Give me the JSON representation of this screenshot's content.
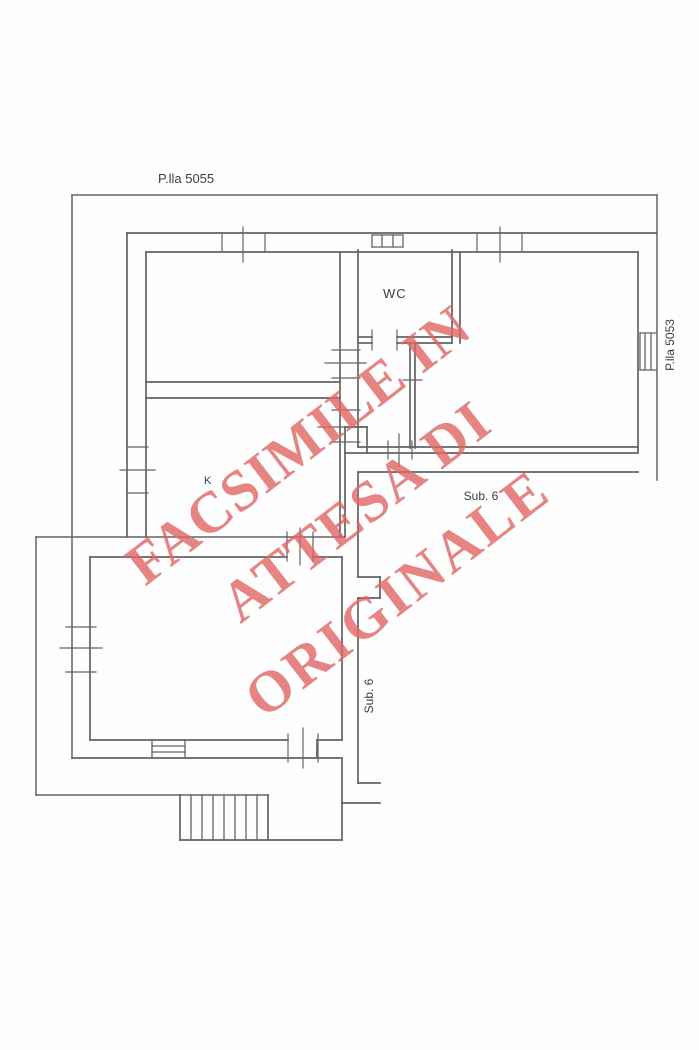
{
  "colors": {
    "line": "#636363",
    "label": "#3c3c3c",
    "watermark": "rgba(224,100,100,0.8)"
  },
  "labels": {
    "parcel_top": "P.lla 5055",
    "parcel_right": "P.lla 5053",
    "wc": "WC",
    "kitchen": "K",
    "sub6_horizontal": "Sub. 6",
    "sub6_vertical": "Sub. 6"
  },
  "watermark": {
    "rotation_deg": -37.5,
    "lines": [
      "FACSIMILE IN",
      "ATTESA DI",
      "ORIGINALE"
    ]
  },
  "floorplan": {
    "width": 699,
    "height": 1050,
    "segments": {
      "boundary": [
        [
          72,
          195,
          657,
          195
        ],
        [
          657,
          195,
          657,
          480
        ],
        [
          72,
          195,
          72,
          758
        ],
        [
          36,
          537,
          36,
          795
        ],
        [
          36,
          537,
          345,
          537
        ],
        [
          36,
          795,
          268,
          795
        ]
      ],
      "wall": [
        [
          127,
          233,
          656,
          233
        ],
        [
          146,
          252,
          638,
          252
        ],
        [
          127,
          233,
          127,
          537
        ],
        [
          146,
          252,
          146,
          537
        ],
        [
          638,
          252,
          638,
          452
        ],
        [
          146,
          382,
          340,
          382
        ],
        [
          146,
          398,
          340,
          398
        ],
        [
          340,
          252,
          340,
          537
        ],
        [
          358,
          250,
          358,
          447
        ],
        [
          452,
          250,
          452,
          343
        ],
        [
          460,
          252,
          460,
          343
        ],
        [
          358,
          337,
          372,
          337
        ],
        [
          397,
          337,
          452,
          337
        ],
        [
          358,
          343,
          372,
          343
        ],
        [
          397,
          343,
          452,
          343
        ],
        [
          410,
          343,
          410,
          448
        ],
        [
          415,
          343,
          415,
          448
        ],
        [
          358,
          447,
          638,
          447
        ],
        [
          345,
          453,
          638,
          453
        ],
        [
          345,
          427,
          367,
          427
        ],
        [
          345,
          427,
          345,
          453
        ],
        [
          367,
          427,
          367,
          453
        ],
        [
          345,
          453,
          345,
          537
        ],
        [
          358,
          472,
          638,
          472
        ],
        [
          358,
          472,
          358,
          577
        ],
        [
          358,
          577,
          380,
          577
        ],
        [
          380,
          577,
          380,
          598
        ],
        [
          380,
          598,
          358,
          598
        ],
        [
          358,
          598,
          358,
          783
        ],
        [
          358,
          783,
          380,
          783
        ],
        [
          342,
          803,
          380,
          803
        ],
        [
          90,
          557,
          287,
          557
        ],
        [
          313,
          557,
          342,
          557
        ],
        [
          90,
          557,
          90,
          740
        ],
        [
          342,
          557,
          342,
          740
        ],
        [
          90,
          740,
          288,
          740
        ],
        [
          317,
          740,
          342,
          740
        ],
        [
          317,
          740,
          317,
          758
        ],
        [
          72,
          758,
          342,
          758
        ],
        [
          342,
          758,
          342,
          840
        ],
        [
          180,
          795,
          180,
          840
        ],
        [
          268,
          795,
          268,
          840
        ],
        [
          180,
          840,
          342,
          840
        ]
      ],
      "window": [
        [
          372,
          235,
          403,
          235
        ],
        [
          372,
          247,
          403,
          247
        ],
        [
          372,
          235,
          372,
          247
        ],
        [
          403,
          235,
          403,
          247
        ],
        [
          382,
          235,
          382,
          247
        ],
        [
          393,
          235,
          393,
          247
        ],
        [
          640,
          333,
          656,
          333
        ],
        [
          640,
          370,
          656,
          370
        ],
        [
          640,
          333,
          640,
          370
        ],
        [
          645,
          333,
          645,
          370
        ],
        [
          651,
          333,
          651,
          370
        ],
        [
          152,
          740,
          152,
          758
        ],
        [
          185,
          740,
          185,
          758
        ],
        [
          152,
          746,
          185,
          746
        ],
        [
          152,
          752,
          185,
          752
        ]
      ],
      "tick": [
        [
          222,
          233,
          222,
          252
        ],
        [
          243,
          227,
          243,
          262
        ],
        [
          265,
          233,
          265,
          252
        ],
        [
          477,
          233,
          477,
          252
        ],
        [
          500,
          227,
          500,
          262
        ],
        [
          522,
          233,
          522,
          252
        ],
        [
          332,
          350,
          360,
          350
        ],
        [
          325,
          363,
          366,
          363
        ],
        [
          332,
          378,
          360,
          378
        ],
        [
          332,
          410,
          360,
          410
        ],
        [
          318,
          427,
          366,
          427
        ],
        [
          332,
          442,
          360,
          442
        ],
        [
          128,
          447,
          148,
          447
        ],
        [
          120,
          470,
          155,
          470
        ],
        [
          128,
          493,
          148,
          493
        ],
        [
          372,
          330,
          372,
          350
        ],
        [
          397,
          330,
          397,
          350
        ],
        [
          403,
          380,
          422,
          380
        ],
        [
          388,
          441,
          388,
          459
        ],
        [
          399,
          434,
          399,
          466
        ],
        [
          412,
          441,
          412,
          459
        ],
        [
          287,
          532,
          287,
          561
        ],
        [
          300,
          528,
          300,
          565
        ],
        [
          313,
          532,
          313,
          561
        ],
        [
          288,
          734,
          288,
          762
        ],
        [
          303,
          728,
          303,
          768
        ],
        [
          318,
          734,
          318,
          762
        ],
        [
          66,
          627,
          96,
          627
        ],
        [
          60,
          648,
          102,
          648
        ],
        [
          66,
          672,
          96,
          672
        ]
      ],
      "hatch": [
        [
          191,
          795,
          191,
          840
        ],
        [
          202,
          795,
          202,
          840
        ],
        [
          213,
          795,
          213,
          840
        ],
        [
          224,
          795,
          224,
          840
        ],
        [
          235,
          795,
          235,
          840
        ],
        [
          246,
          795,
          246,
          840
        ],
        [
          257,
          795,
          257,
          840
        ]
      ]
    }
  }
}
